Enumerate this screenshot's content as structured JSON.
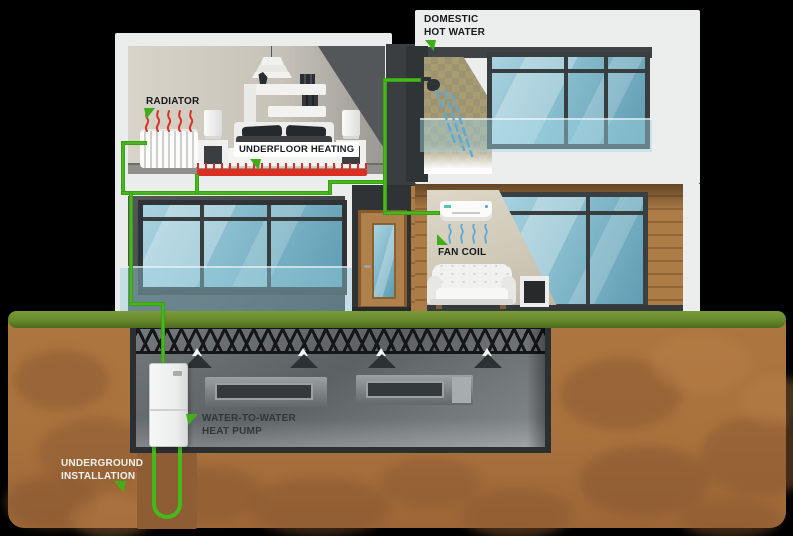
{
  "diagram": {
    "type": "heating-system-cutaway",
    "labels": {
      "radiator": "RADIATOR",
      "underfloor_heating": "UNDERFLOOR HEATING",
      "domestic_hot_water_line1": "DOMESTIC",
      "domestic_hot_water_line2": "HOT WATER",
      "fan_coil": "FAN COIL",
      "heat_pump_line1": "WATER-TO-WATER",
      "heat_pump_line2": "HEAT PUMP",
      "underground_line1": "UNDERGROUND",
      "underground_line2": "INSTALLATION"
    },
    "colors": {
      "pipe_green": "#46b81c",
      "marker_green": "#3fae19",
      "heating_red": "#dc2f23",
      "water_blue": "#5da8d8",
      "grass_green": "#66882b",
      "soil_brown": "#a9723d",
      "label_dark": "#17191b",
      "label_light": "#f4f2ee"
    },
    "icons": {
      "marker": "green-triangle",
      "shower_head": "dark-circle-with-arm",
      "water_spray": "blue-dashed-diagonal-lines",
      "heat_waves": "red-wavy-lines",
      "airflow": "blue-wavy-lines",
      "ceiling_lamp": "dark-cone-with-white-bulb",
      "chandelier": "tiered-trapezoids"
    }
  }
}
